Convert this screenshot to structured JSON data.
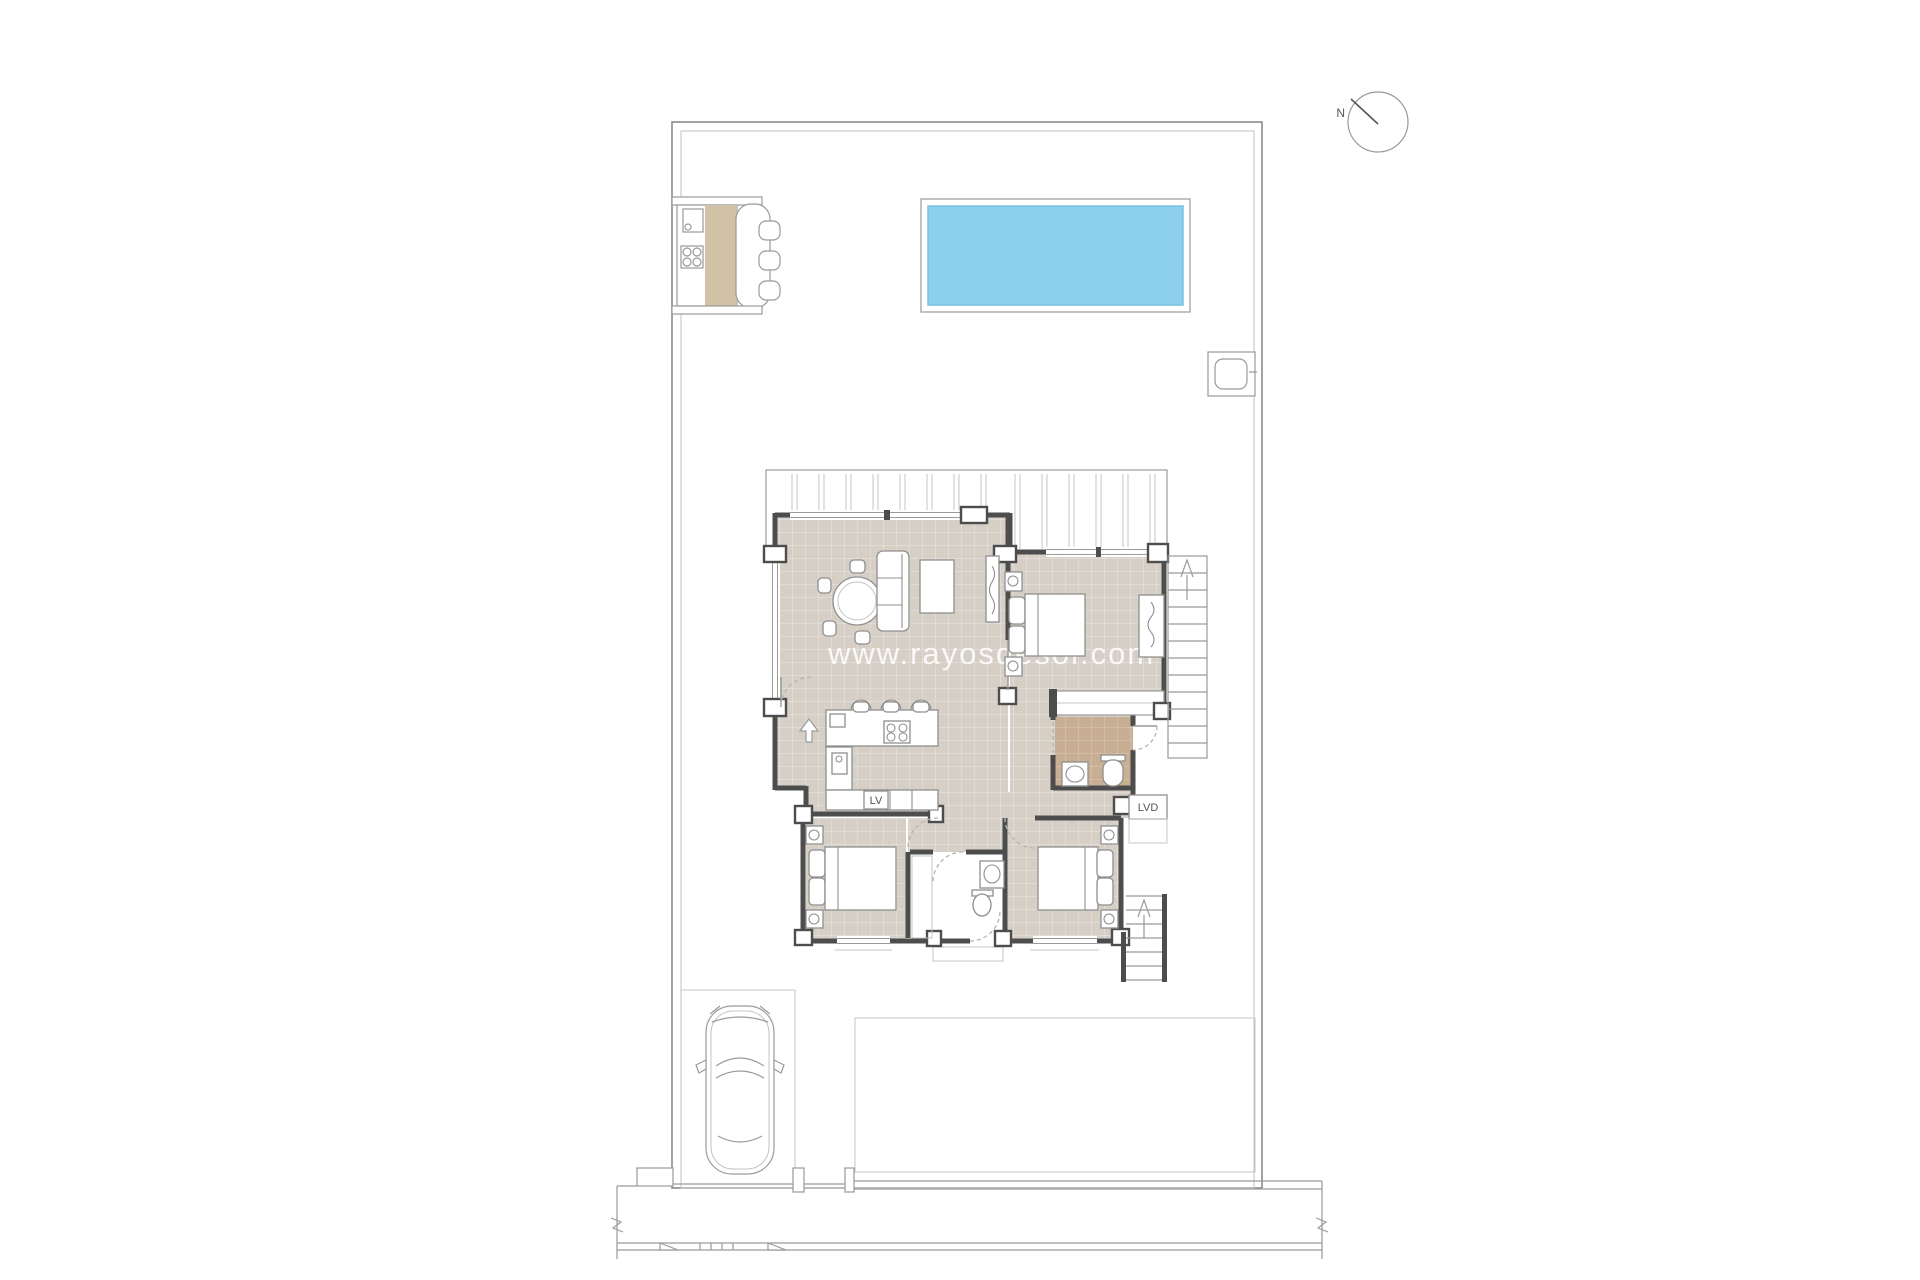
{
  "watermark": {
    "text": "www.rayosdesol.com"
  },
  "compass": {
    "north_label": "N"
  },
  "labels": {
    "dishwasher": "LV",
    "laundry": "LVD"
  },
  "colors": {
    "floor": "#d6cfc5",
    "floor_warm": "#c8ae92",
    "counter": "#d1c1a6",
    "wall": "#4d4d4d",
    "line": "#9a9a9a",
    "line_light": "#c4c4c4",
    "pool": "#8ccfee",
    "pool_edge": "#79c0e0",
    "watermark": "rgba(255,255,255,0.85)",
    "label_text": "#555555"
  }
}
